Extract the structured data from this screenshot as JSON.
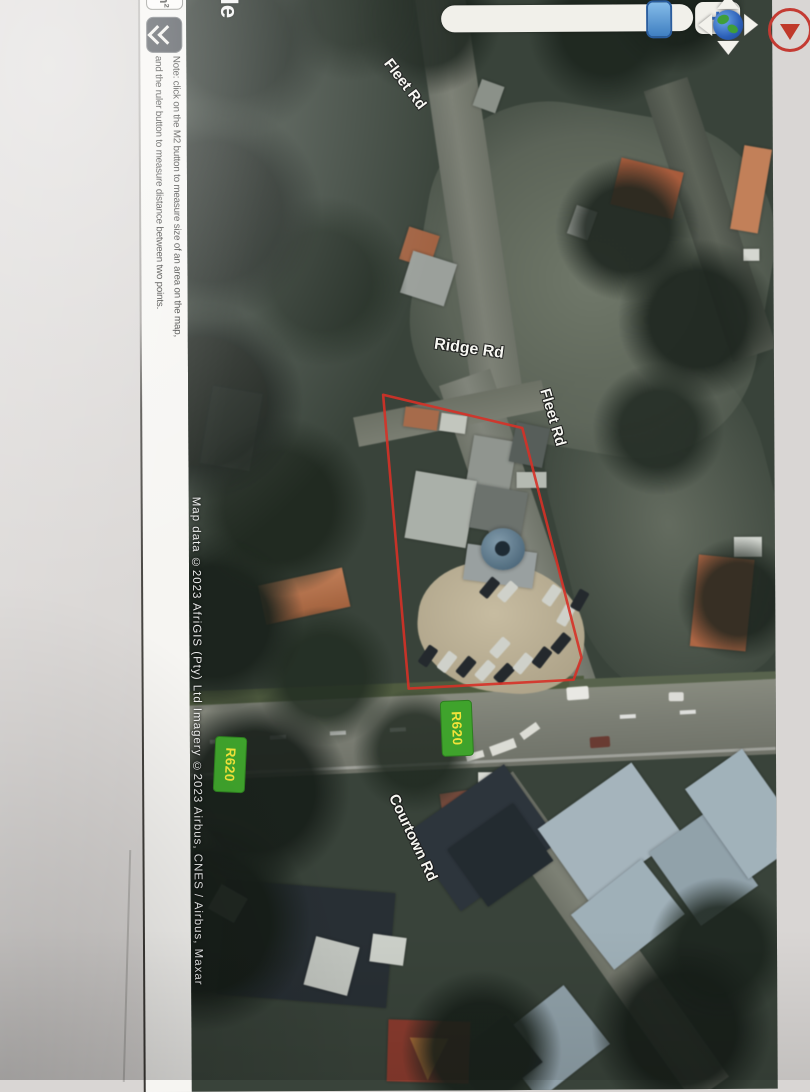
{
  "screenshot": {
    "toolbar": {
      "m2_button_label": "m²",
      "note_line1": "Note: click on the M2 button to measure size of an area on the map,",
      "note_line2": "and the ruler button to measure distance between two points."
    },
    "map": {
      "watermark_tail": "gle",
      "attribution": "Map data ©2023 AfriGIS (Pty) Ltd Imagery ©2023 Airbus, CNES / Airbus, Maxar",
      "zoom_plus_label": "+",
      "road_labels": {
        "fleet_rd_upper": "Fleet Rd",
        "ridge_rd": "Ridge Rd",
        "fleet_rd_lower": "Fleet Rd",
        "courtown_rd": "Courtown Rd"
      },
      "route_shields": {
        "west": "R620",
        "east": "R620"
      },
      "colors": {
        "route_shield_bg": "#3fa32c",
        "route_shield_text": "#f2e33a",
        "parcel_outline": "#d63127",
        "slider_handle": "#4a86c8"
      }
    }
  }
}
